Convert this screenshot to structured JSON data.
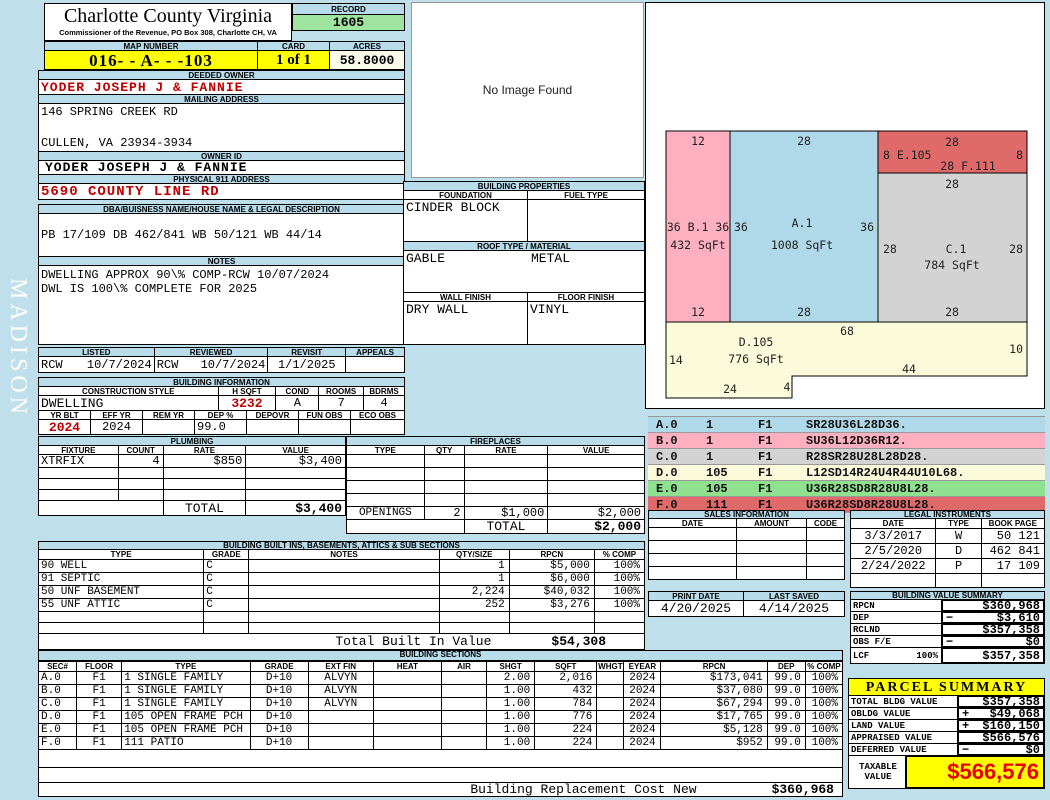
{
  "page": {
    "watermark": "MADISON"
  },
  "colors": {
    "bar_blue": "#B9DCEA",
    "record_green": "#9FE49F",
    "highlight_yellow": "#FFFF00",
    "acres_cream": "#FAFAE8",
    "accent_red": "#C00000",
    "taxable_red": "#E80000",
    "sketch_pink": "#FFB0C0",
    "sketch_blue": "#AFD8E8",
    "sketch_red": "#E06A6A",
    "sketch_gray": "#D3D3D3",
    "sketch_yellow": "#FBFADB",
    "legend_green": "#8FE18F"
  },
  "header": {
    "county": "Charlotte County Virginia",
    "commissioner": "Commissioner of the Revenue, PO Box 308, Charlotte CH, VA",
    "record_label": "RECORD",
    "record_value": "1605",
    "map_label": "MAP NUMBER",
    "map_number": "016- - A- -  -103",
    "card_label": "CARD",
    "card_value": "1 of 1",
    "acres_label": "ACRES",
    "acres_value": "58.8000"
  },
  "photo": {
    "text": "No Image Found"
  },
  "owner": {
    "deeded_label": "DEEDED OWNER",
    "deeded": "YODER JOSEPH J & FANNIE",
    "mailing_label": "MAILING ADDRESS",
    "mailing1": "146 SPRING CREEK RD",
    "mailing2": "CULLEN, VA 23934-3934",
    "ownerid_label": "OWNER ID",
    "ownerid": "YODER JOSEPH J & FANNIE",
    "physical_label": "PHYSICAL 911 ADDRESS",
    "physical": "5690 COUNTY LINE RD",
    "legal_label": "DBA/BUISNESS NAME/HOUSE NAME & LEGAL DESCRIPTION",
    "legal": "PB 17/109 DB 462/841 WB 50/121 WB 44/14",
    "notes_label": "NOTES",
    "note1": "DWELLING APPROX 90\\% COMP-RCW 10/07/2024",
    "note2": "DWL IS 100\\% COMPLETE FOR 2025"
  },
  "review": {
    "listed_label": "LISTED",
    "listed_by": "RCW",
    "listed_date": "10/7/2024",
    "reviewed_label": "REVIEWED",
    "reviewed_by": "RCW",
    "reviewed_date": "10/7/2024",
    "revisit_label": "REVISIT",
    "revisit": "1/1/2025",
    "appeals_label": "APPEALS",
    "appeals": ""
  },
  "building_info": {
    "title": "BUILDING INFORMATION",
    "style_label": "CONSTRUCTION STYLE",
    "style": "DWELLING",
    "hsqft_label": "H SQFT",
    "hsqft": "3232",
    "cond_label": "COND",
    "cond": "A",
    "rooms_label": "ROOMS",
    "rooms": "7",
    "bdrms_label": "BDRMS",
    "bdrms": "4",
    "yrblt_label": "YR BLT",
    "yrblt": "2024",
    "effyr_label": "EFF YR",
    "effyr": "2024",
    "remyr_label": "REM YR",
    "remyr": "",
    "dep_label": "DEP %",
    "dep": "99.0",
    "depovr_label": "DEPOVR",
    "depovr": "",
    "funobs_label": "FUN OBS",
    "funobs": "",
    "ecoobs_label": "ECO OBS",
    "ecoobs": ""
  },
  "properties": {
    "title": "BUILDING PROPERTIES",
    "foundation_label": "FOUNDATION",
    "foundation": "CINDER BLOCK",
    "fuel_label": "FUEL TYPE",
    "fuel": "",
    "roof_label": "ROOF TYPE / MATERIAL",
    "roof_type": "GABLE",
    "roof_material": "METAL",
    "wall_label": "WALL FINISH",
    "wall": "DRY WALL",
    "floor_label": "FLOOR FINISH",
    "floor": "VINYL"
  },
  "plumbing": {
    "title": "PLUMBING",
    "headers": [
      "FIXTURE",
      "COUNT",
      "RATE",
      "VALUE"
    ],
    "fixture": "XTRFIX",
    "count": "4",
    "rate": "$850",
    "value": "$3,400",
    "total_label": "TOTAL",
    "total": "$3,400"
  },
  "fireplaces": {
    "title": "FIREPLACES",
    "headers": [
      "TYPE",
      "QTY",
      "RATE",
      "VALUE"
    ],
    "openings_label": "OPENINGS",
    "openings_qty": "2",
    "openings_rate": "$1,000",
    "openings_value": "$2,000",
    "total_label": "TOTAL",
    "total": "$2,000"
  },
  "builtins": {
    "title": "BUILDING BUILT INS, BASEMENTS, ATTICS & SUB SECTIONS",
    "headers": [
      "TYPE",
      "GRADE",
      "NOTES",
      "QTY/SIZE",
      "RPCN",
      "% COMP"
    ],
    "rows": [
      [
        "90 WELL",
        "C",
        "",
        "1",
        "$5,000",
        "100%"
      ],
      [
        "91 SEPTIC",
        "C",
        "",
        "1",
        "$6,000",
        "100%"
      ],
      [
        "50 UNF BASEMENT",
        "C",
        "",
        "2,224",
        "$40,032",
        "100%"
      ],
      [
        "55 UNF ATTIC",
        "C",
        "",
        "252",
        "$3,276",
        "100%"
      ]
    ],
    "total_label": "Total Built In Value",
    "total": "$54,308"
  },
  "sections": {
    "title": "BUILDING SECTIONS",
    "headers": [
      "SEC#",
      "FLOOR",
      "TYPE",
      "GRADE",
      "EXT FIN",
      "HEAT",
      "AIR",
      "SHGT",
      "SQFT",
      "WHGT",
      "EYEAR",
      "RPCN",
      "DEP",
      "% COMP"
    ],
    "rows": [
      [
        "A.0",
        "F1",
        "1 SINGLE FAMILY",
        "D+10",
        "ALVYN",
        "",
        "",
        "2.00",
        "2,016",
        "",
        "2024",
        "$173,041",
        "99.0",
        "100%"
      ],
      [
        "B.0",
        "F1",
        "1 SINGLE FAMILY",
        "D+10",
        "ALVYN",
        "",
        "",
        "1.00",
        "432",
        "",
        "2024",
        "$37,080",
        "99.0",
        "100%"
      ],
      [
        "C.0",
        "F1",
        "1 SINGLE FAMILY",
        "D+10",
        "ALVYN",
        "",
        "",
        "1.00",
        "784",
        "",
        "2024",
        "$67,294",
        "99.0",
        "100%"
      ],
      [
        "D.0",
        "F1",
        "105 OPEN FRAME PCH",
        "D+10",
        "",
        "",
        "",
        "1.00",
        "776",
        "",
        "2024",
        "$17,765",
        "99.0",
        "100%"
      ],
      [
        "E.0",
        "F1",
        "105 OPEN FRAME PCH",
        "D+10",
        "",
        "",
        "",
        "1.00",
        "224",
        "",
        "2024",
        "$5,128",
        "99.0",
        "100%"
      ],
      [
        "F.0",
        "F1",
        "111 PATIO",
        "D+10",
        "",
        "",
        "",
        "1.00",
        "224",
        "",
        "2024",
        "$952",
        "99.0",
        "100%"
      ]
    ],
    "brcn_label": "Building Replacement Cost New",
    "brcn": "$360,968"
  },
  "sketch": {
    "b1": {
      "top": "12",
      "mid": "36 B.1 36",
      "sqft": "432 SqFt",
      "bottom": "12"
    },
    "a1": {
      "top": "28",
      "left": "36",
      "name": "A.1",
      "sqft": "1008 SqFt",
      "right": "36",
      "bottom": "28"
    },
    "ef": {
      "top": "28",
      "left": "8 E.105",
      "right": "8",
      "mid": "28  F.111"
    },
    "c1": {
      "top": "28",
      "left": "28",
      "name": "C.1",
      "sqft": "784 SqFt",
      "right": "28",
      "bottom": "28"
    },
    "d105": {
      "top": "68",
      "name": "D.105",
      "sqft": "776 SqFt",
      "left": "14",
      "right": "10",
      "d44": "44",
      "d24": "24",
      "d4": "4"
    },
    "legend": [
      {
        "sec": "A.0",
        "num": "1",
        "floor": "F1",
        "vector": "SR28U36L28D36."
      },
      {
        "sec": "B.0",
        "num": "1",
        "floor": "F1",
        "vector": "SU36L12D36R12."
      },
      {
        "sec": "C.0",
        "num": "1",
        "floor": "F1",
        "vector": "R28SR28U28L28D28."
      },
      {
        "sec": "D.0",
        "num": "105",
        "floor": "F1",
        "vector": "L12SD14R24U4R44U10L68."
      },
      {
        "sec": "E.0",
        "num": "105",
        "floor": "F1",
        "vector": "U36R28SD8R28U8L28."
      },
      {
        "sec": "F.0",
        "num": "111",
        "floor": "F1",
        "vector": "U36R28SD8R28U8L28."
      }
    ]
  },
  "sales": {
    "title": "SALES INFORMATION",
    "headers": [
      "DATE",
      "AMOUNT",
      "CODE"
    ]
  },
  "instruments": {
    "title": "LEGAL INSTRUMENTS",
    "headers": [
      "DATE",
      "TYPE",
      "BOOK PAGE"
    ],
    "rows": [
      [
        "3/3/2017",
        "W",
        "50 121"
      ],
      [
        "2/5/2020",
        "D",
        "462 841"
      ],
      [
        "2/24/2022",
        "P",
        "17 109"
      ]
    ]
  },
  "dates": {
    "print_label": "PRINT DATE",
    "print": "4/20/2025",
    "saved_label": "LAST SAVED",
    "saved": "4/14/2025"
  },
  "value_summary": {
    "title": "BUILDING VALUE SUMMARY",
    "rows": [
      {
        "label": "RPCN",
        "pct": "",
        "op": "",
        "value": "$360,968"
      },
      {
        "label": "DEP",
        "pct": "",
        "op": "−",
        "value": "$3,610"
      },
      {
        "label": "RCLND",
        "pct": "",
        "op": "",
        "value": "$357,358"
      },
      {
        "label": "OBS F/E",
        "pct": "",
        "op": "−",
        "value": "$0"
      },
      {
        "label": "LCF",
        "pct": "100%",
        "op": "",
        "value": "$357,358"
      }
    ]
  },
  "parcel": {
    "title": "PARCEL SUMMARY",
    "rows": [
      {
        "label": "TOTAL BLDG VALUE",
        "op": "",
        "value": "$357,358"
      },
      {
        "label": "OBLDG VALUE",
        "op": "+",
        "value": "$49,068"
      },
      {
        "label": "LAND VALUE",
        "op": "+",
        "value": "$160,150"
      },
      {
        "label": "APPRAISED VALUE",
        "op": "",
        "value": "$566,576"
      },
      {
        "label": "DEFERRED VALUE",
        "op": "−",
        "value": "$0"
      }
    ],
    "taxable_label": "TAXABLE VALUE",
    "taxable": "$566,576"
  }
}
